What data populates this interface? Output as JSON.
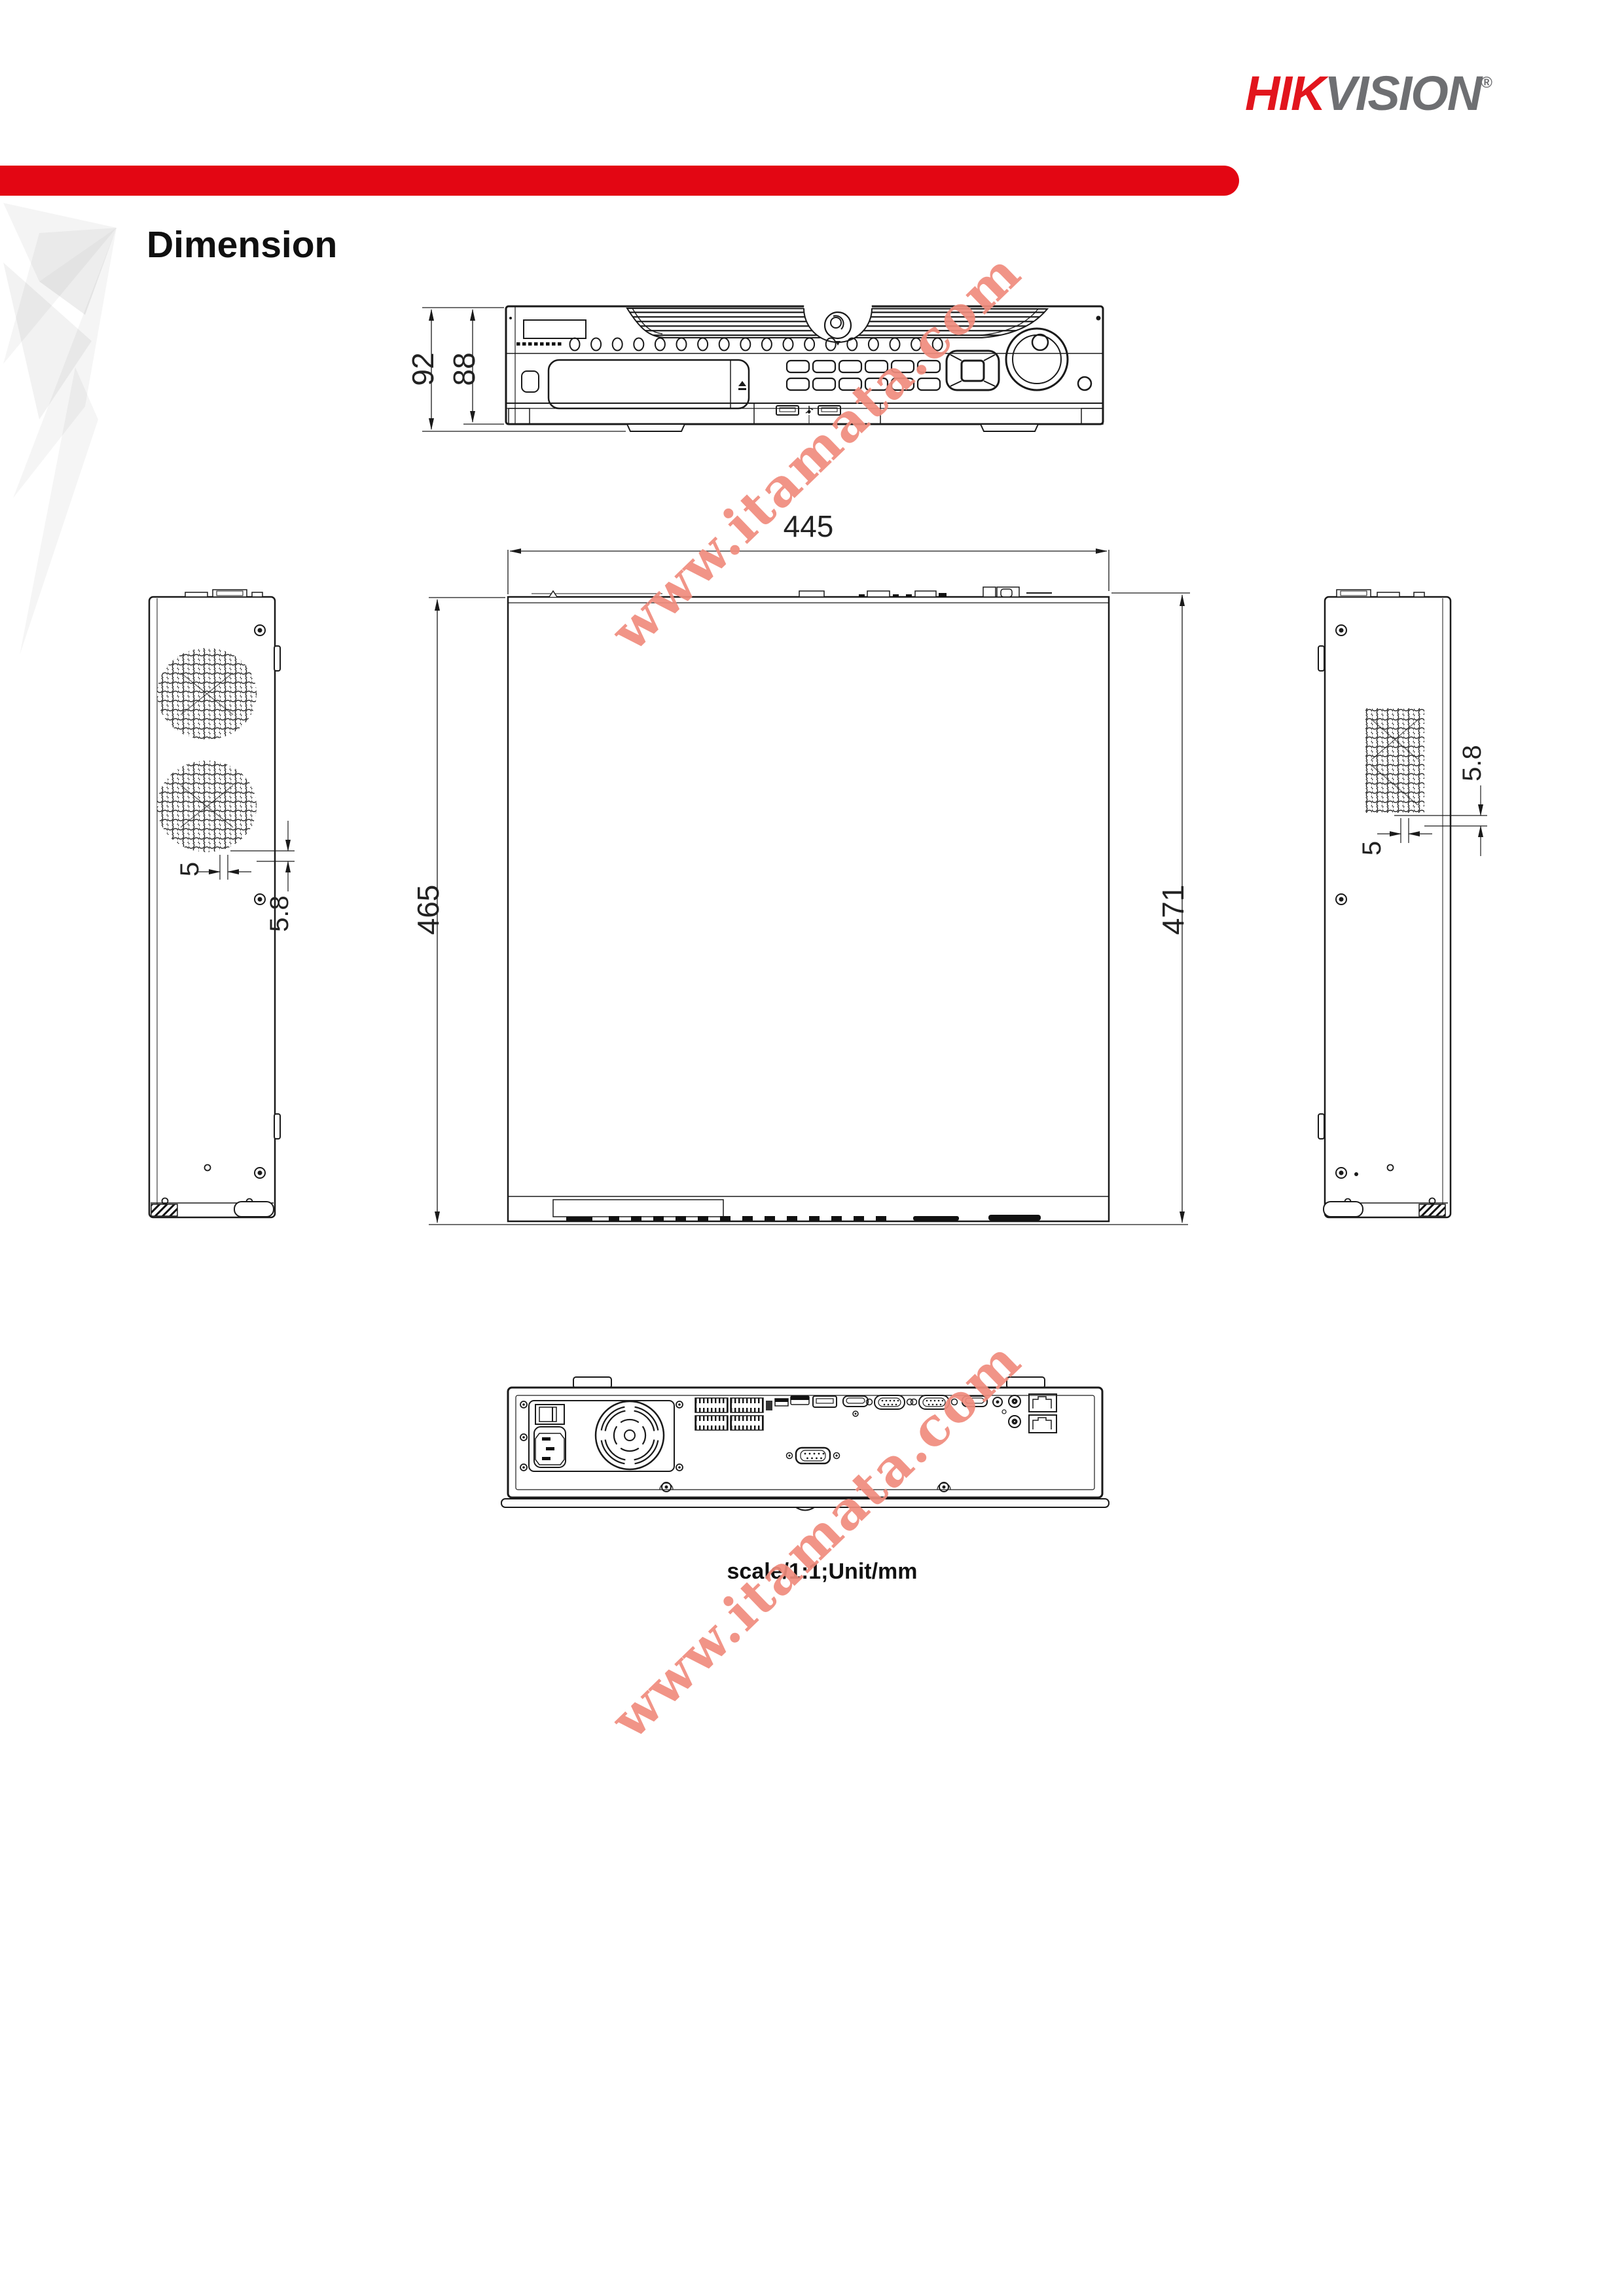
{
  "header": {
    "logo": {
      "hik": "HIK",
      "vision": "VISION",
      "registered": "®"
    }
  },
  "title": "Dimension",
  "watermark": {
    "text": "www.itamata.com"
  },
  "views": {
    "front": {
      "dim_height_total": "92",
      "dim_height_body": "88"
    },
    "top": {
      "dim_width": "445",
      "dim_depth": "465",
      "dim_depth_overall": "471"
    },
    "left_side": {
      "dim_gap": "5",
      "dim_offset": "5.8"
    },
    "right_side": {
      "dim_gap": "5",
      "dim_offset": "5.8"
    },
    "rear": {
      "scale_note": "scale/1:1;Unit/mm"
    }
  },
  "colors": {
    "brand_red": "#E2151D",
    "ribbon_red": "#E30613",
    "logo_gray": "#6E6F72",
    "line_black": "#1A1A1A",
    "watermark_salmon": "#F08C7D"
  },
  "units": "mm"
}
